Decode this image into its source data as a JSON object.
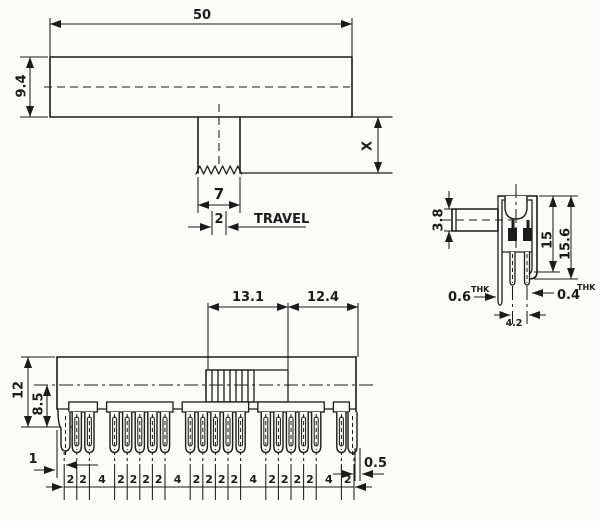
{
  "colors": {
    "ink": "#1b1b1b",
    "paper": "#fbfbf8"
  },
  "top_view": {
    "width": "50",
    "height": "9.4",
    "lever_width": "7",
    "travel_value": "2",
    "travel_label": "TRAVEL",
    "lever_height": "X"
  },
  "side_view": {
    "lever_thickness": "3.8",
    "height_inner": "15",
    "height_outer": "15.6",
    "bracket_thickness": {
      "value": "0.6",
      "unit": "THK"
    },
    "terminal_thickness": {
      "value": "0.4",
      "unit": "THK"
    },
    "terminal_span": "4.2"
  },
  "bottom_view": {
    "slider_span_left": "13.1",
    "slider_span_right": "12.4",
    "body_height": "12",
    "center_height": "8.5",
    "edge_offset_left": "1",
    "edge_offset_right": "0.5",
    "pin_spacings": [
      "2",
      "2",
      "4",
      "2",
      "2",
      "2",
      "2",
      "4",
      "2",
      "2",
      "2",
      "2",
      "4",
      "2",
      "2",
      "2",
      "2",
      "4",
      "2"
    ]
  }
}
